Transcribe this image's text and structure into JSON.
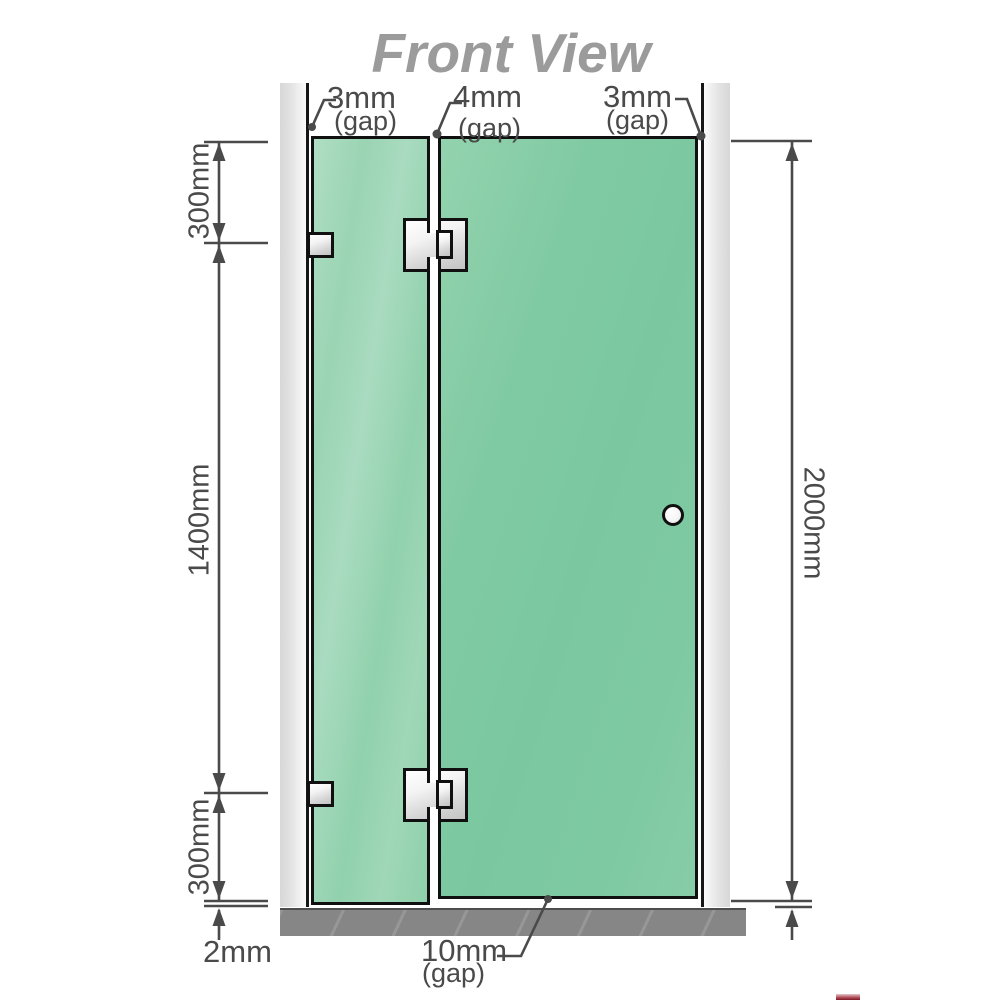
{
  "title": "Front View",
  "colors": {
    "glass_green": "#7cc9a2",
    "glass_green_light": "#9ed6b6",
    "wall_gray": "#dedede",
    "floor_gray": "#868686",
    "outline_black": "#101010",
    "dimension_gray": "#4a4a4a",
    "title_gray": "#9b9b9b"
  },
  "annotations": {
    "gap_left": {
      "value": "3mm",
      "qualifier": "(gap)"
    },
    "gap_middle": {
      "value": "4mm",
      "qualifier": "(gap)"
    },
    "gap_right": {
      "value": "3mm",
      "qualifier": "(gap)"
    },
    "gap_bottom": {
      "value": "10mm",
      "qualifier": "(gap)"
    },
    "bottom_clearance": "2mm",
    "left_segment_top": "300mm",
    "left_segment_middle": "1400mm",
    "left_segment_bottom": "300mm",
    "right_total_height": "2000mm"
  },
  "components": {
    "left_wall": "wall",
    "right_wall": "wall",
    "fixed_panel": "fixed glass panel",
    "door_panel": "hinged glass door",
    "floor": "floor base",
    "knob": "door knob",
    "hinges": "glass-to-glass hinges",
    "brackets": "wall brackets"
  }
}
